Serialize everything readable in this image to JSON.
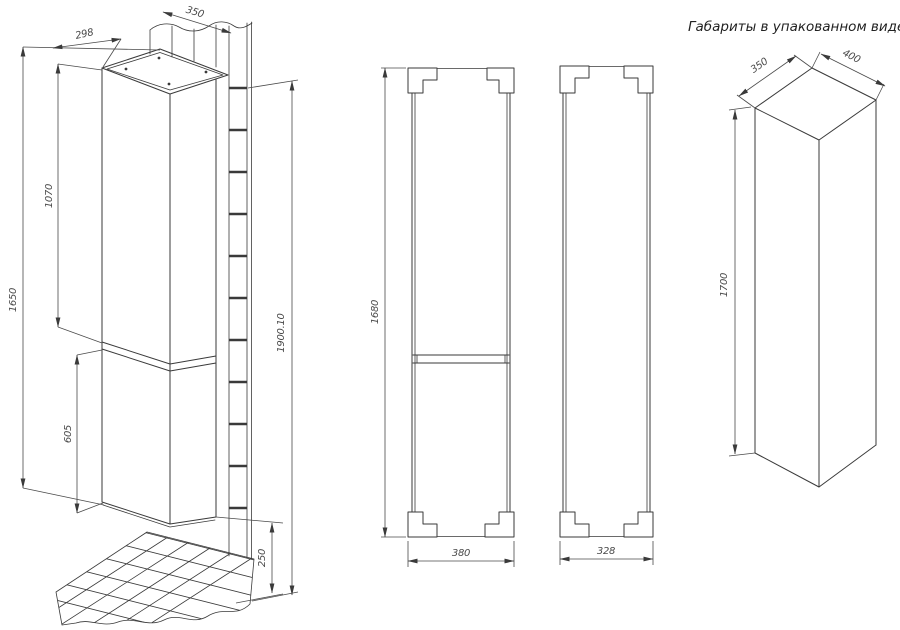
{
  "drawing": {
    "package_title": "Габариты в упакованном виде",
    "iso": {
      "depth": "298",
      "width": "350",
      "upper_door_height": "1070",
      "cabinet_height": "1650",
      "lower_door_height": "605",
      "floor_clearance": "250",
      "total_height": "1900.10"
    },
    "front": {
      "height": "1680",
      "width": "380"
    },
    "side": {
      "depth": "328"
    },
    "package": {
      "depth": "350",
      "width": "400",
      "height": "1700"
    }
  }
}
